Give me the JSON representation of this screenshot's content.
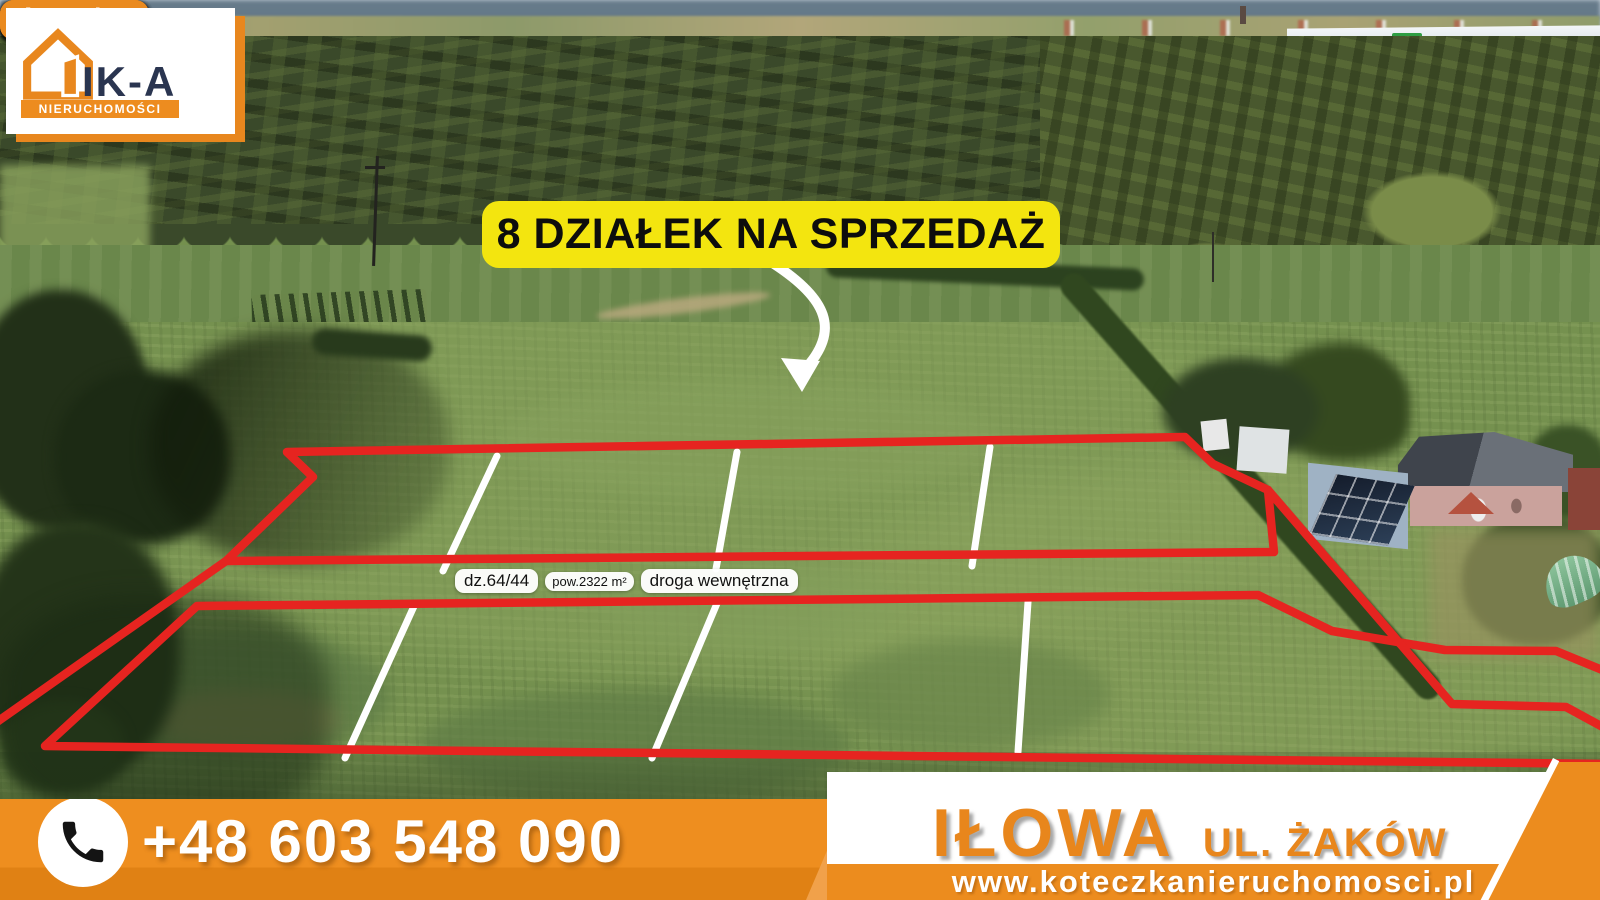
{
  "logo": {
    "brand": "IK-A",
    "subtitle": "NIERUCHOMOŚCI",
    "icon": "house-outline-icon"
  },
  "banner": {
    "text": "8 DZIAŁEK NA SPRZEDAŻ"
  },
  "plots": [
    {
      "id": "dz.64/43",
      "area": "pow.853 m²"
    },
    {
      "id": "dz.64/42",
      "area": "pow.856 m²"
    },
    {
      "id": "dz.64/41",
      "area": "pow.856 m²"
    },
    {
      "id": "dz.64/40",
      "area": "pow.878 m²"
    },
    {
      "id": "dz.64/48",
      "area": "pow.924 m²"
    },
    {
      "id": "dz.64/47",
      "area": "pow.1033 m²"
    },
    {
      "id": "dz.64/46",
      "area": "pow.1069 m²"
    },
    {
      "id": "dz.64/45",
      "area": "pow.1127 m²"
    }
  ],
  "road": {
    "id": "dz.64/44",
    "area": "pow.2322 m²",
    "name": "droga wewnętrzna"
  },
  "contact": {
    "phone": "+48 603 548 090",
    "phone_icon": "phone-handset-icon"
  },
  "location": {
    "city": "IŁOWA",
    "street": "UL. ŻAKÓW"
  },
  "website": {
    "url": "www.koteczkanieruchomosci.pl"
  },
  "colors": {
    "accent_orange": "#EC8C1E",
    "plot_red": "#E62420",
    "banner_yellow": "#F3E50F",
    "brand_navy": "#2A3550"
  }
}
